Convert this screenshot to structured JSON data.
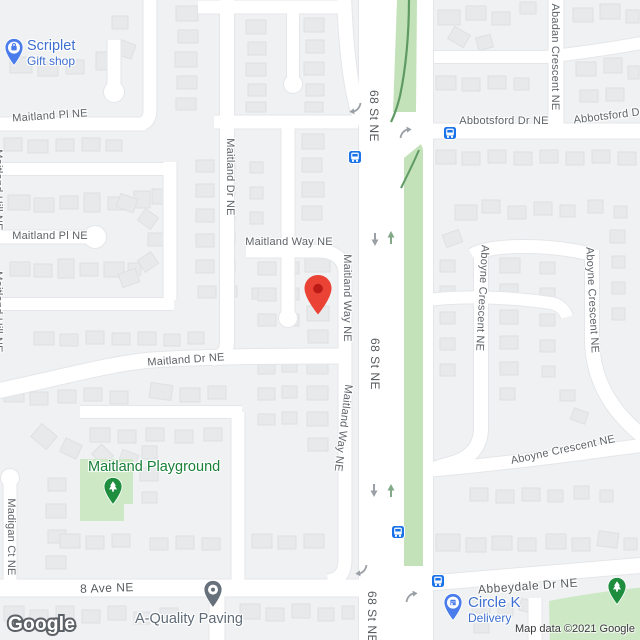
{
  "map": {
    "attribution": "Map data ©2021 Google",
    "watermark": "Google"
  },
  "palette": {
    "land": "#f0f1f2",
    "road": "#ffffff",
    "road_casing": "#e4e6e9",
    "building": "#e8e9eb",
    "building_line": "#dee0e2",
    "park": "#cde8c5",
    "median": "#c3e2ba",
    "trail": "#5f9a63",
    "transit_blue": "#1a73e8",
    "poi_blue": "#4a7cec",
    "poi_blue_text": "#3d6ed0",
    "poi_green": "#1e8e3e",
    "poi_green_text": "#188038",
    "poi_gray": "#67717c",
    "poi_gray_text": "#5f6b78",
    "marker_red": "#EA4335",
    "arrow_gray": "#9aa0a6",
    "arrow_green": "#83a989"
  },
  "pois": {
    "scriplet": {
      "name": "Scriplet",
      "category": "Gift shop",
      "icon": "shopping-bag-pin-icon",
      "x": 14,
      "y": 47
    },
    "playground": {
      "name": "Maitland Playground",
      "icon": "tree-pin-icon",
      "x": 113,
      "y": 486
    },
    "paving": {
      "name": "A-Quality Paving",
      "icon": "place-pin-icon",
      "x": 213,
      "y": 592
    },
    "circle_k": {
      "name": "Circle K",
      "category": "Delivery",
      "icon": "store-pin-icon",
      "x": 453,
      "y": 602
    },
    "abbeydale_tree": {
      "name": "",
      "icon": "tree-pin-icon",
      "x": 617,
      "y": 588
    }
  },
  "marker": {
    "label": "Dropped pin",
    "x": 318,
    "y": 315
  },
  "street_labels": [
    {
      "text": "Maitland Pl NE",
      "x": 50,
      "y": 116,
      "rot": -4,
      "cls": ""
    },
    {
      "text": "Maitland Pl NE",
      "x": 50,
      "y": 236,
      "rot": 0,
      "cls": ""
    },
    {
      "text": "Maitland Dr NE",
      "x": 230,
      "y": 177,
      "rot": 90,
      "cls": ""
    },
    {
      "text": "Maitland Way NE",
      "x": 289,
      "y": 242,
      "rot": 0,
      "cls": ""
    },
    {
      "text": "Maitland Way NE",
      "x": 347,
      "y": 298,
      "rot": 90,
      "cls": ""
    },
    {
      "text": "Maitland Way NE",
      "x": 343,
      "y": 428,
      "rot": 97,
      "cls": ""
    },
    {
      "text": "Maitland Dr NE",
      "x": 186,
      "y": 360,
      "rot": -4,
      "cls": ""
    },
    {
      "text": "68 St NE",
      "x": 374,
      "y": 116,
      "rot": 90,
      "cls": "arterial"
    },
    {
      "text": "68 St NE",
      "x": 375,
      "y": 364,
      "rot": 90,
      "cls": "arterial"
    },
    {
      "text": "68 St NE",
      "x": 372,
      "y": 617,
      "rot": 90,
      "cls": "arterial"
    },
    {
      "text": "Abadan Crescent NE",
      "x": 555,
      "y": 57,
      "rot": 90,
      "cls": ""
    },
    {
      "text": "Abbotsford Dr NE",
      "x": 504,
      "y": 121,
      "rot": 0,
      "cls": ""
    },
    {
      "text": "Abbotsford Dr NE",
      "x": 618,
      "y": 115,
      "rot": -7,
      "cls": ""
    },
    {
      "text": "Aboyne Crescent NE",
      "x": 482,
      "y": 298,
      "rot": 93,
      "cls": ""
    },
    {
      "text": "Aboyne Crescent NE",
      "x": 592,
      "y": 300,
      "rot": 87,
      "cls": ""
    },
    {
      "text": "Aboyne Crescent NE",
      "x": 563,
      "y": 450,
      "rot": -12,
      "cls": ""
    },
    {
      "text": "Abbeydale Dr NE",
      "x": 528,
      "y": 586,
      "rot": -4,
      "cls": "arterial"
    },
    {
      "text": "8 Ave NE",
      "x": 107,
      "y": 588,
      "rot": -2,
      "cls": "arterial"
    },
    {
      "text": "Madigan Ct NE",
      "x": 11,
      "y": 537,
      "rot": 90,
      "cls": ""
    },
    {
      "text": "Maitland Hill NE",
      "x": -2,
      "y": 190,
      "rot": 90,
      "cls": ""
    },
    {
      "text": "Maitland Hill NE",
      "x": -2,
      "y": 312,
      "rot": 90,
      "cls": ""
    }
  ],
  "transit_stops": [
    {
      "x": 355,
      "y": 157
    },
    {
      "x": 450,
      "y": 133
    },
    {
      "x": 398,
      "y": 532
    },
    {
      "x": 438,
      "y": 581
    }
  ],
  "traffic_arrows": [
    {
      "type": "oneway-down",
      "x": 375,
      "y": 239
    },
    {
      "type": "oneway-up",
      "x": 391,
      "y": 238
    },
    {
      "type": "oneway-down",
      "x": 374,
      "y": 490
    },
    {
      "type": "oneway-up",
      "x": 391,
      "y": 491
    },
    {
      "type": "turn-sw",
      "x": 356,
      "y": 108
    },
    {
      "type": "turn-ne",
      "x": 405,
      "y": 133
    },
    {
      "type": "turn-sw",
      "x": 362,
      "y": 570
    },
    {
      "type": "turn-ne",
      "x": 411,
      "y": 597
    }
  ]
}
